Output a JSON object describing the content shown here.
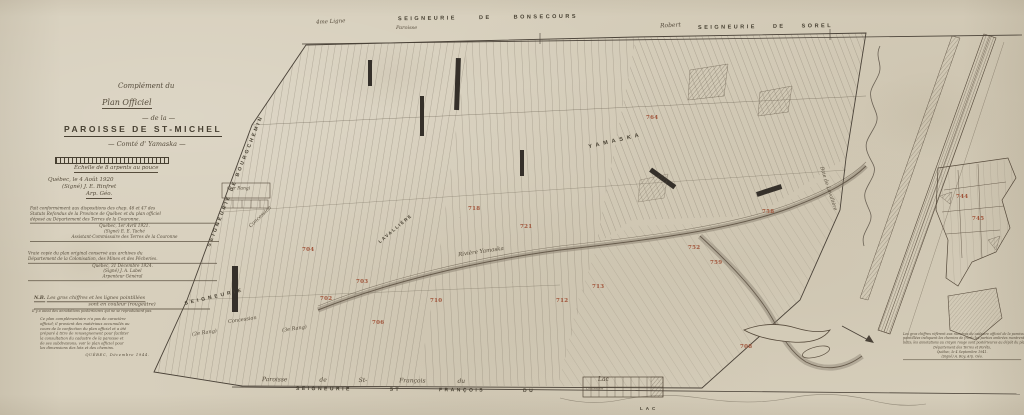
{
  "colors": {
    "paper": "#d7cfbc",
    "ink": "#4a4238",
    "faint": "#6b6254",
    "red": "#a0543a"
  },
  "title_block": {
    "l1": "Complément du",
    "l2": "Plan Officiel",
    "l3": "— de la —",
    "title": "PAROISSE DE ST-MICHEL",
    "subtitle": "— Comté d' Yamaska —"
  },
  "scale": {
    "caption": "Échelle de 8 arpents au pouce"
  },
  "notes": {
    "survey": {
      "l1": "Québec, le 4 Août 1920",
      "l2": "(Signé) J. E. Rinfret",
      "l3": "Arp. Géo."
    },
    "certification": {
      "l1": "Fait conformément aux dispositions des chap. 46 et 47 des",
      "l2": "Statuts Refondus de la Province de Québec et du plan officiel",
      "l3": "déposé au Département des Terres de la Couronne.",
      "l4": "Québec, 1er Avril 1921.",
      "l5": "(Signé) E. E. Taché",
      "l6": "Assistant-Commissaire des Terres de la Couronne"
    },
    "copy": {
      "l1": "Vraie copie du plan original conservé aux archives du",
      "l2": "Département de la Colonisation, des Mines et des Pêcheries.",
      "l3": "Québec, 31 Décembre 1924.",
      "l4": "(Signé) J. A. Label",
      "l5": "Arpenteur Général"
    },
    "nb": {
      "head": "N.B.",
      "head_text": "Les gros chiffres et les lignes pointillées",
      "sub": "sont en couleur (rougeâtre)",
      "sub2": "Il y a aussi des annotations postérieures qui ne se reproduisent pas.",
      "p1": "Ce plan complémentaire n'a pas de caractère",
      "p2": "officiel; il provient des matériaux accumulés au",
      "p3": "cours de la confection du plan officiel et a été",
      "p4": "préparé à titre de renseignement pour faciliter",
      "p5": "la consultation du cadastre de la paroisse et",
      "p6": "de ses subdivisions; voir le plan officiel pour",
      "p7": "les dimensions des lots et des chemins.",
      "p9": "QUÉBEC,   Décembre 1944."
    },
    "corner": {
      "l1": "Les gros chiffres réfèrent aux numéros du cadastre officiel de la paroisse; les lignes",
      "l2": "pointillées indiquent les chemins de front; les parties ombrées montrent les terrains",
      "l3": "bâtis; les annotations au crayon rouge sont postérieures au dépôt du plan.",
      "l4": "Département des Terres et Forêts,",
      "l5": "Québec, le 4 Septembre 1941.",
      "l6": "(Signé) A. Roy, Arp. Géo."
    }
  },
  "boundaries": {
    "top_script_left": "4me Ligne",
    "top_script_paroisse": "Paroisse",
    "top_caps": "SEIGNEURIE DE BONSECOURS",
    "top_script_right": "Robert",
    "top_caps_right": "SEIGNEURIE DE SOREL",
    "left_diag": "SEIGNEURIE DE BOURGCHEMIN",
    "left_diag2": "SEIGNEURIE",
    "bottom_script": "Paroisse de St- François du",
    "bottom_caps": "SEIGNEURIE ST FRANÇOIS DU",
    "bottom_lac_script": "Lac",
    "bottom_ladder_label": "Concession",
    "bottom_lac_caps": "LAC"
  },
  "map_labels": [
    {
      "text": "YAMASKA"
    },
    {
      "text": "LAVALLIÈRE"
    },
    {
      "text": "Rivière Yamaska"
    },
    {
      "text": "Concession"
    },
    {
      "text": "(1er Rang)"
    },
    {
      "text": "Concession"
    },
    {
      "text": "(2e Rang)"
    },
    {
      "text": "(3e Rang)"
    },
    {
      "text": "Baie de Lavallière"
    }
  ],
  "lot_numbers": [
    {
      "v": "702"
    },
    {
      "v": "703"
    },
    {
      "v": "704"
    },
    {
      "v": "706"
    },
    {
      "v": "708"
    },
    {
      "v": "710"
    },
    {
      "v": "712"
    },
    {
      "v": "713"
    },
    {
      "v": "718"
    },
    {
      "v": "721"
    },
    {
      "v": "744"
    },
    {
      "v": "745"
    },
    {
      "v": "752"
    },
    {
      "v": "758"
    },
    {
      "v": "759"
    },
    {
      "v": "764"
    }
  ]
}
